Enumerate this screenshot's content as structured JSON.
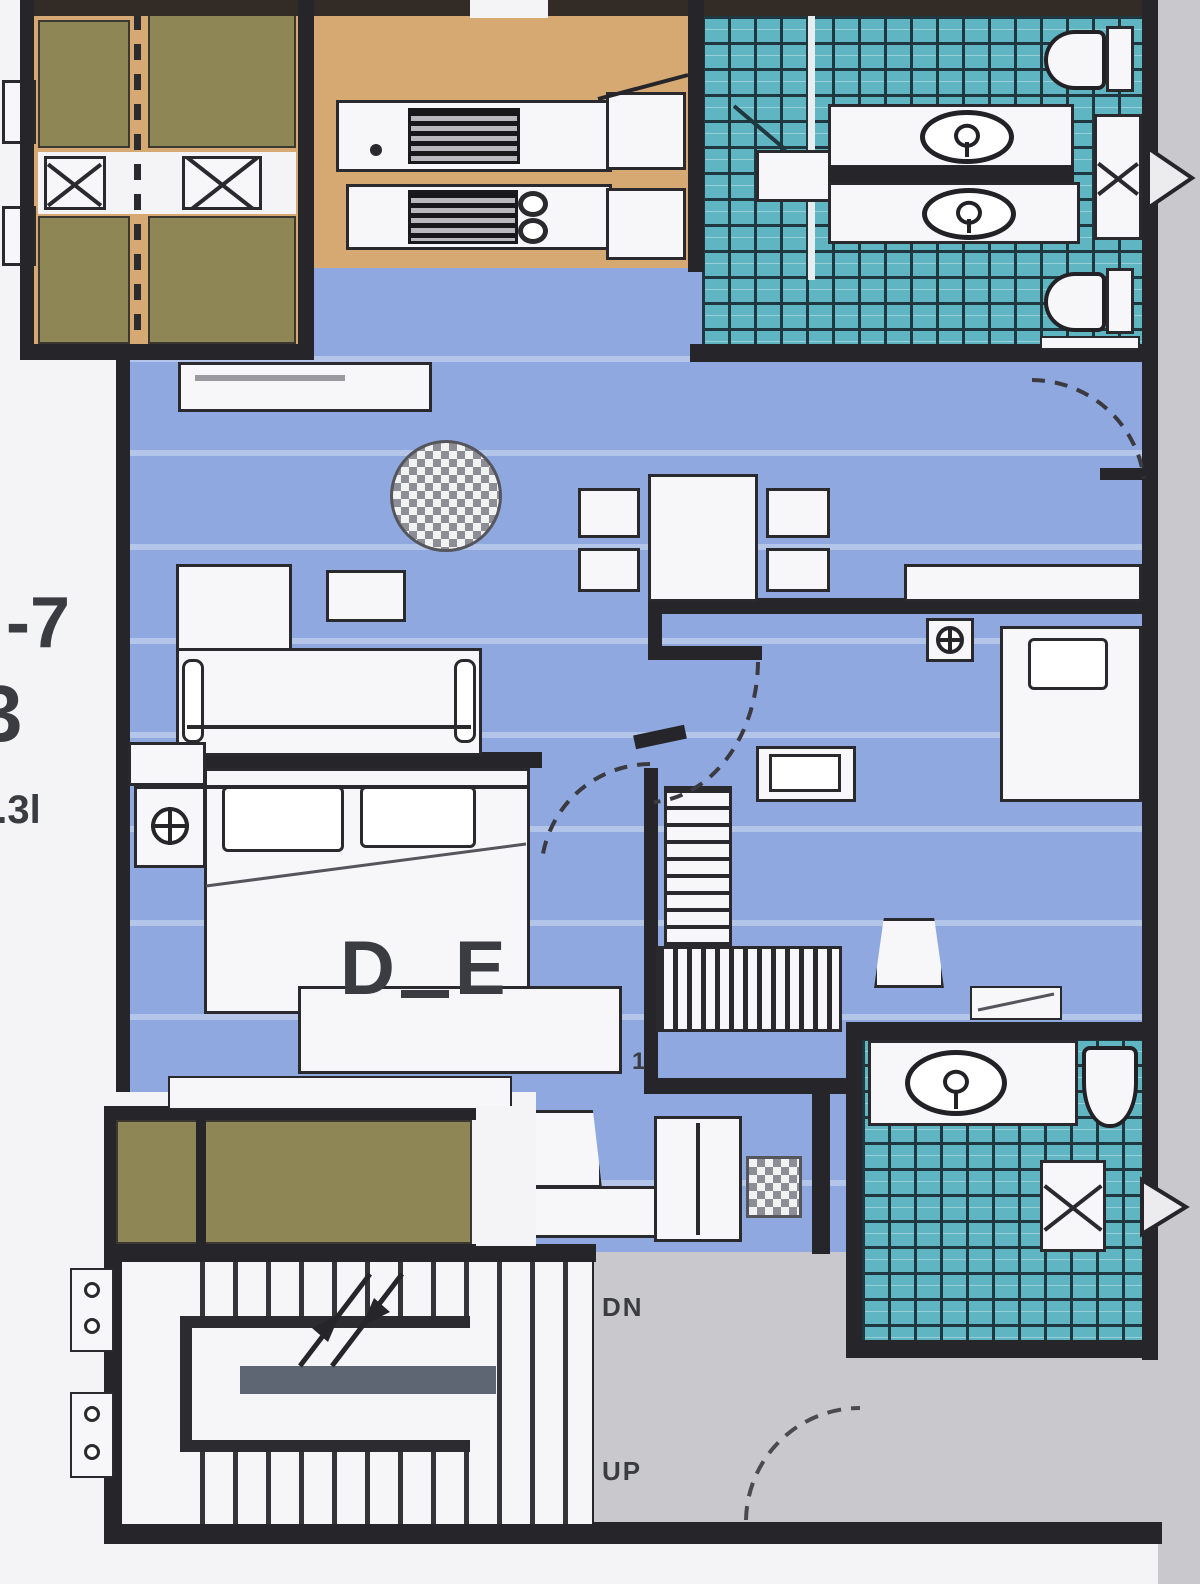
{
  "document": {
    "kind": "scanned apartment floor plan"
  },
  "margin_labels": {
    "unit_suffix": "-7",
    "unit_letter": "3",
    "small_note": "1.3l"
  },
  "stairwell": {
    "down_label": "DN",
    "up_label": "UP"
  },
  "bedroom1": {
    "letter_d": "D",
    "letter_e": "E"
  },
  "annotations": {
    "door_number": "1"
  },
  "icons": {
    "round-rug": "checkered-circle",
    "double-sink": "two-stacked-circles (8 shape)",
    "stove": "dark-striped-block",
    "washbasin": "oval-with-faucet-cross",
    "toilet": "bowl-with-tank",
    "ac-fan": "circle-with-cross",
    "shaft-x": "box-with-diagonal-cross",
    "stair-arrows": "double-diagonal-with-arrowheads",
    "door-swing": "dashed-quarter-arc"
  },
  "colors": {
    "wall": "#26262a",
    "floor-blue": "#8fa9e0",
    "floor-teal": "#5fb6c2",
    "floor-olive": "#8e8655",
    "floor-tan": "#d6a972",
    "floor-gray": "#c9c9cd",
    "ink": "#3b3b42"
  }
}
